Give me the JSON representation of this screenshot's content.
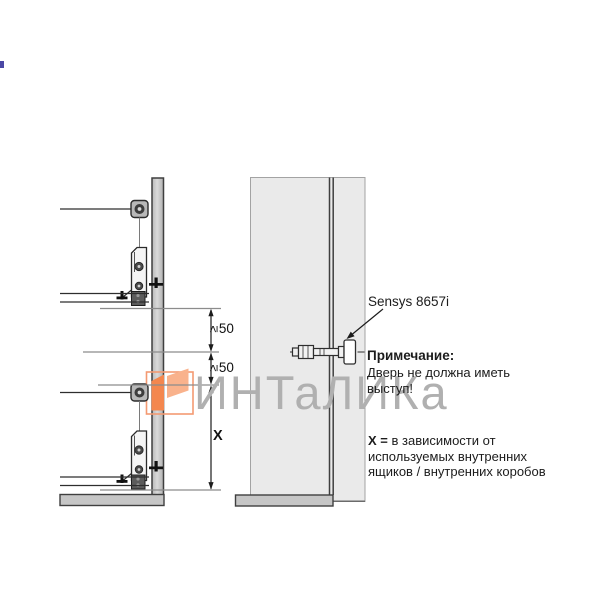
{
  "watermark": {
    "text": "ИНТаЛИКа",
    "color_gray": "#b0b0b0",
    "logo_orange": "#f4874e",
    "logo_orange_light": "#f9b28c"
  },
  "left_diagram": {
    "dim1_symbol": "≥",
    "dim1_value": "50",
    "dim2_symbol": "≥",
    "dim2_value": "50",
    "dim_x_label": "X"
  },
  "right_diagram": {
    "hinge_label": "Sensys 8657i"
  },
  "note": {
    "title": "Примечание:",
    "line1": "Дверь не должна иметь",
    "line2": "выступ!"
  },
  "x_note": {
    "prefix": "X =",
    "line1": " в зависимости от",
    "line2": "используемых внутренних",
    "line3": "ящиков / внутренних коробов"
  },
  "colors": {
    "panel_strip_fill": "#c9c9c9",
    "panel_large_fill": "#eaeaea",
    "bottom_bar_fill": "#c6c6c6",
    "line_dark": "#2e2e2e",
    "line_gray": "#8c8c8c"
  }
}
